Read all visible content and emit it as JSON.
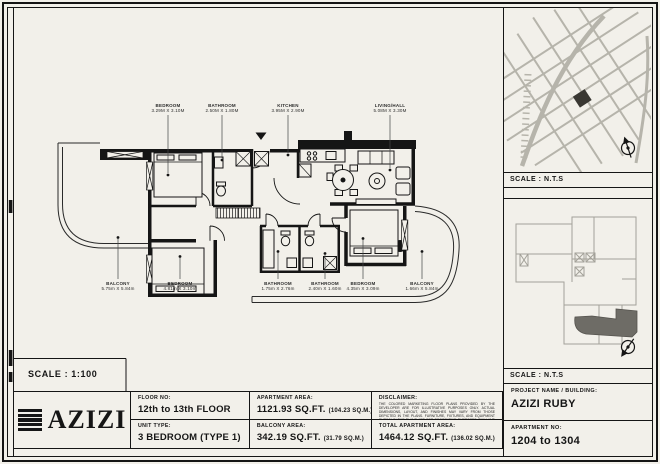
{
  "plan": {
    "scale_label": "SCALE : 1:100",
    "labels_top": [
      {
        "name": "BEDROOM",
        "dims": "3.29M X 3.10M"
      },
      {
        "name": "BATHROOM",
        "dims": "2.50M X 1.80M"
      },
      {
        "name": "KITCHEN",
        "dims": "3.95M X 2.90M"
      },
      {
        "name": "LIVING/HALL",
        "dims": "5.08M X 3.30M"
      }
    ],
    "labels_bottom": [
      {
        "name": "BALCONY",
        "dims": "5.75m X 5.84m"
      },
      {
        "name": "BEDROOM",
        "dims": "4.81m X 3.10m"
      },
      {
        "name": "BATHROOM",
        "dims": "1.75m X 2.76m"
      },
      {
        "name": "BATHROOM",
        "dims": "2.40m X 1.60m"
      },
      {
        "name": "BEDROOM",
        "dims": "4.35m X 3.09m"
      },
      {
        "name": "BALCONY",
        "dims": "1.66m X 5.84m"
      }
    ]
  },
  "side": {
    "location_map_scale": "SCALE : N.T.S",
    "key_plan_scale": "SCALE : N.T.S",
    "project_label": "PROJECT NAME / BUILDING:",
    "project_value": "AZIZI RUBY",
    "apartment_no_label": "APARTMENT NO:",
    "apartment_no_value": "1204 to 1304"
  },
  "titleblock": {
    "logo_text": "AZIZI",
    "floor_label": "FLOOR NO:",
    "floor_value": "12th to 13th FLOOR",
    "unit_label": "UNIT TYPE:",
    "unit_value": "3 BEDROOM (TYPE 1)",
    "apt_area_label": "APARTMENT AREA:",
    "apt_area_value": "1121.93 SQ.FT.",
    "apt_area_metric": "(104.23 SQ.M.)",
    "balcony_area_label": "BALCONY AREA:",
    "balcony_area_value": "342.19 SQ.FT.",
    "balcony_area_metric": "(31.79 SQ.M.)",
    "disclaimer_label": "DISCLAIMER:",
    "disclaimer_text": "THE COLORED MARKETING FLOOR PLANS PROVIDED BY THE DEVELOPER ARE FOR ILLUSTRATIVE PURPOSES ONLY. ACTUAL DIMENSIONS, LAYOUT, AND FINISHES MAY VARY FROM THOSE DEPICTED IN THE PLANS. FURNITURE, FIXTURES, AND EQUIPMENT SHOWN IN THE PLANS ARE FOR DECORATIVE PURPOSES ONLY AND ARE NOT INCLUDED IN THE PURCHASE OF LEASE OF THE PROPERTY. THE DEVELOPER RESERVES THE RIGHT TO MAKE MODIFICATIONS, REVISIONS, AND CHANGES TO THE FLOOR PLANS, SPECIFICATIONS, AND FEATURES WITHOUT PRIOR NOTICE.",
    "total_area_label": "TOTAL APARTMENT AREA:",
    "total_area_value": "1464.12 SQ.FT.",
    "total_area_metric": "(136.02 SQ.M.)"
  },
  "colors": {
    "paper": "#f2f0ea",
    "ink": "#151515",
    "map_road": "#b6b4ab",
    "map_highlight": "#3a3833",
    "keyplan_outline": "#a3a199",
    "keyplan_highlight": "#6e6c66"
  }
}
